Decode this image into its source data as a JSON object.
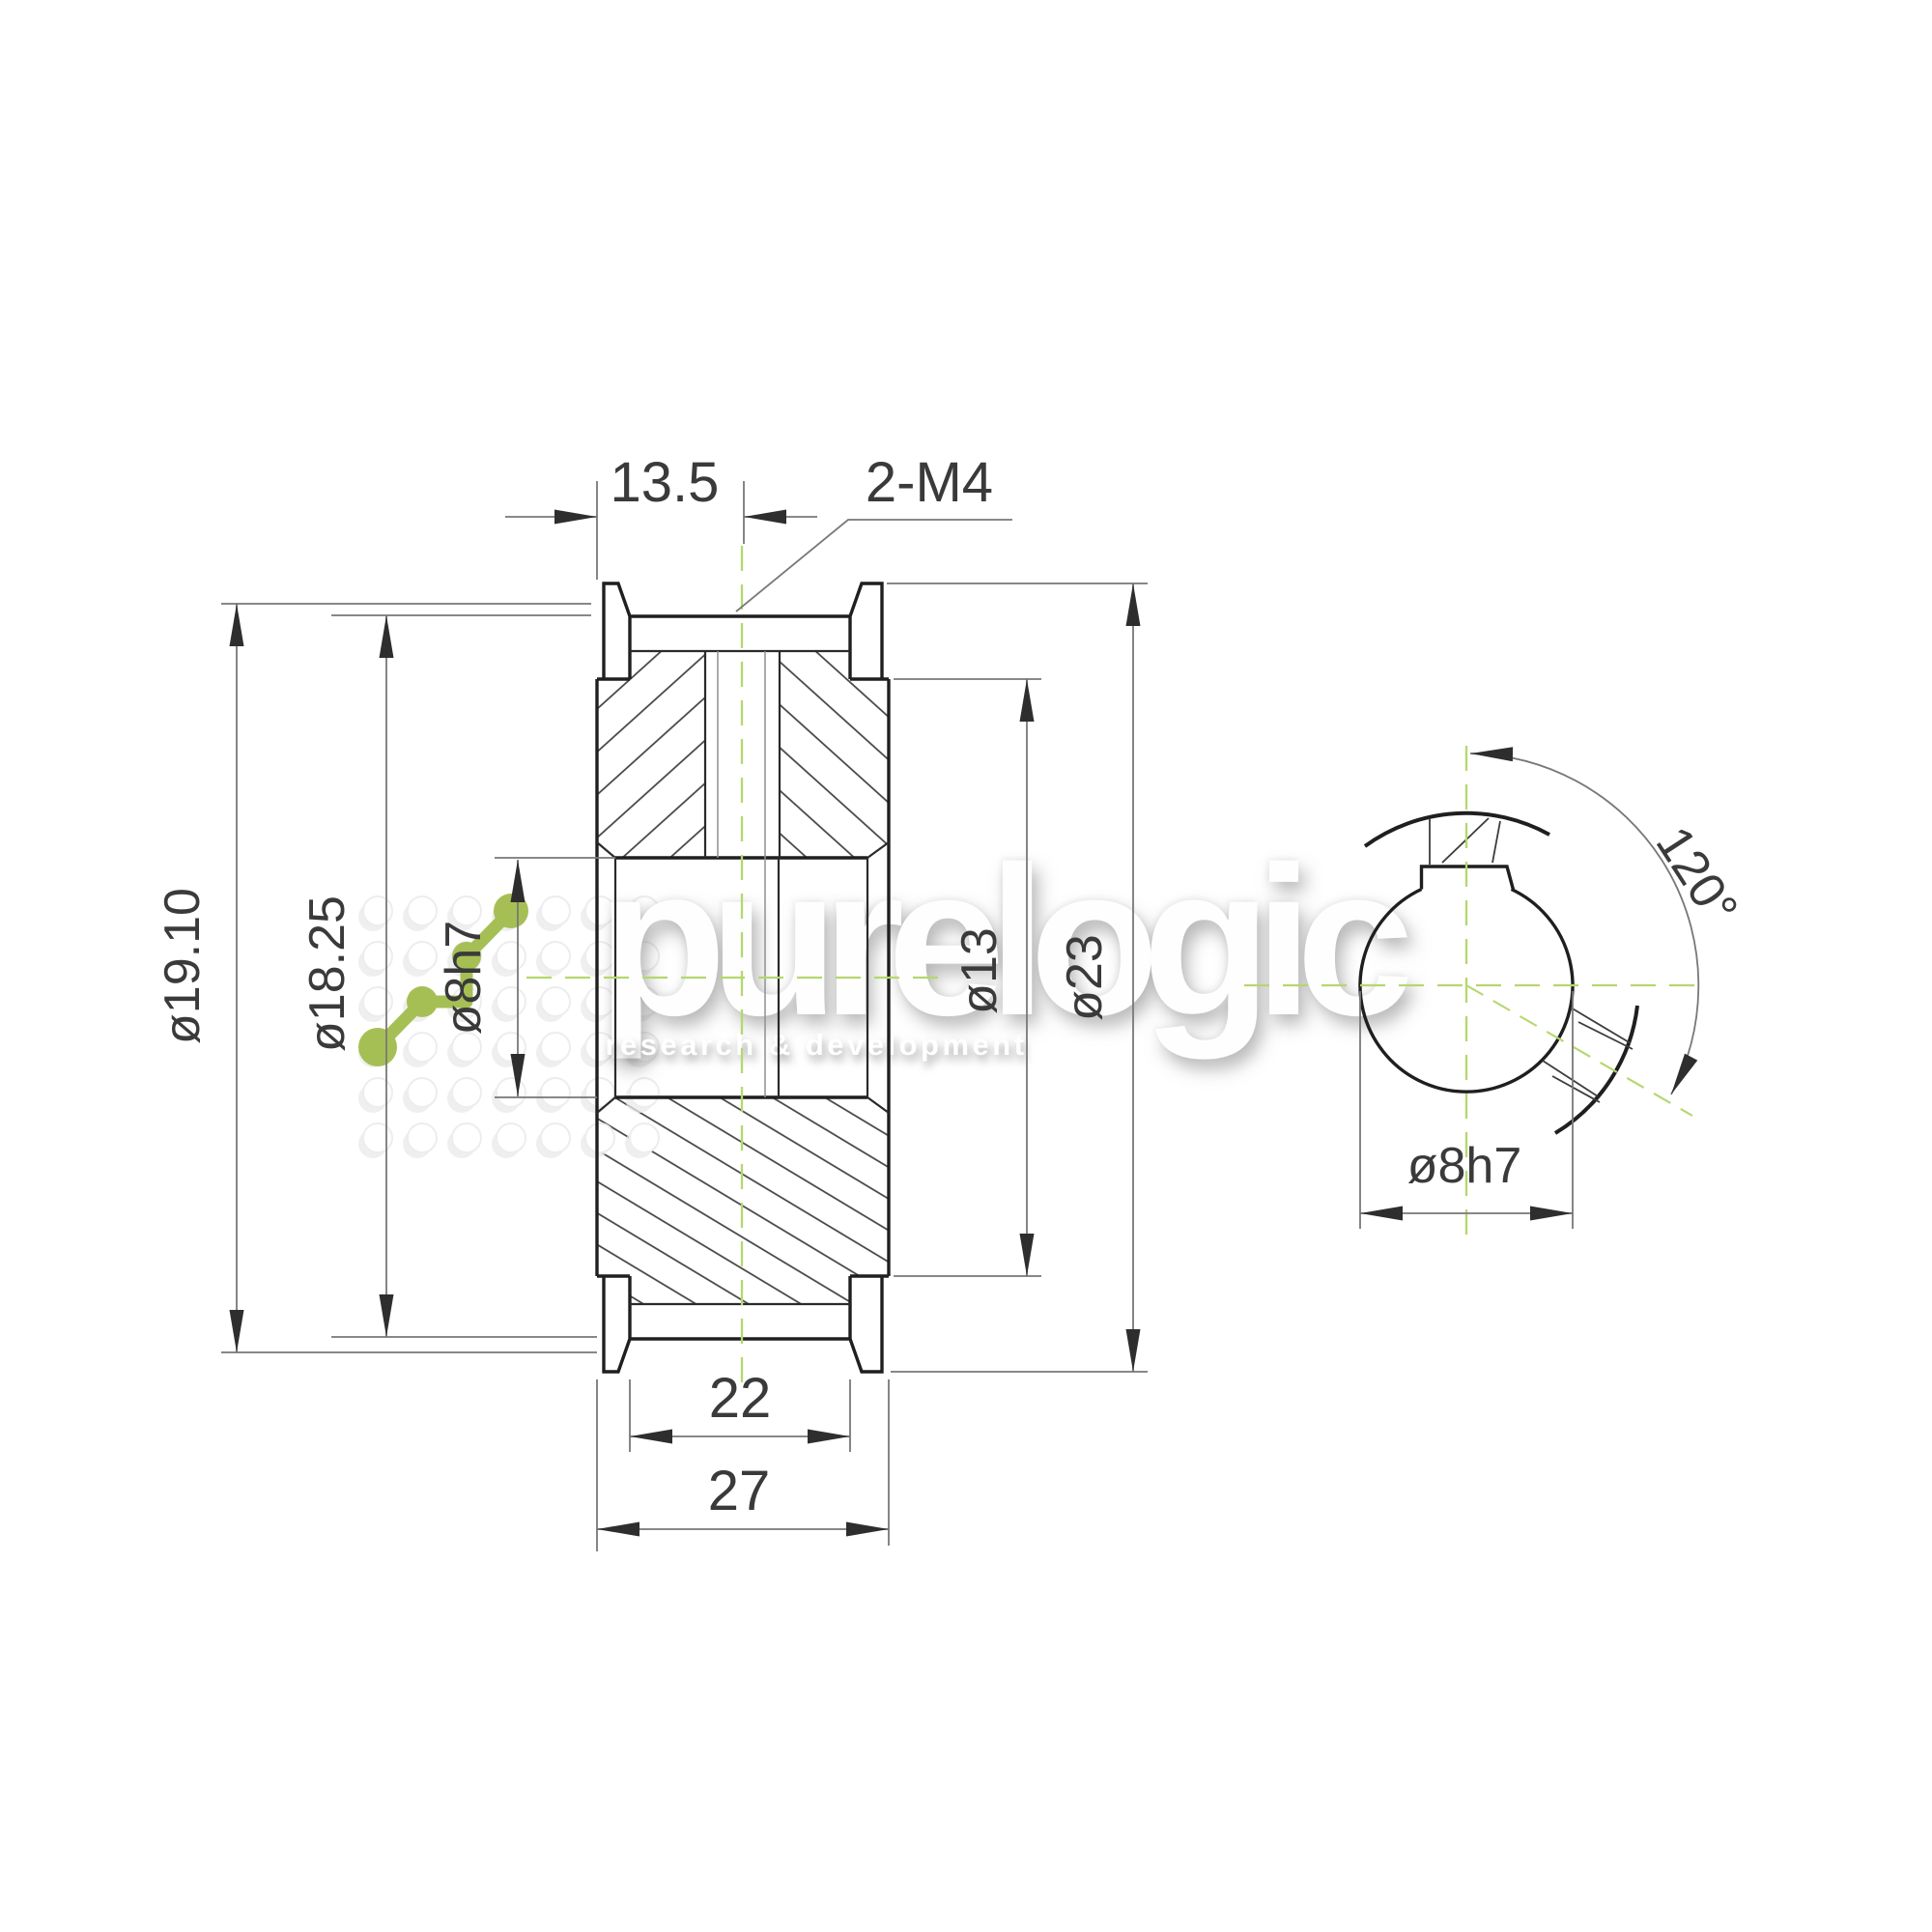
{
  "drawing": {
    "title": "timing pulley drawing",
    "dimensions": {
      "face_to_screw": "13.5",
      "screw_spec": "2-M4",
      "pitch_diameter": "ø19.10",
      "outside_diameter": "ø18.25",
      "bore_side": "ø8h7",
      "hub_diameter": "ø13",
      "flange_diameter": "ø23",
      "belt_width": "22",
      "overall_width": "27",
      "screw_angle": "120°",
      "bore_end": "ø8h7"
    },
    "watermark": {
      "brand": "purelogic",
      "tagline": "research & development",
      "brand_color": "#a6bf54",
      "centerline_color": "#b5d76e"
    }
  }
}
